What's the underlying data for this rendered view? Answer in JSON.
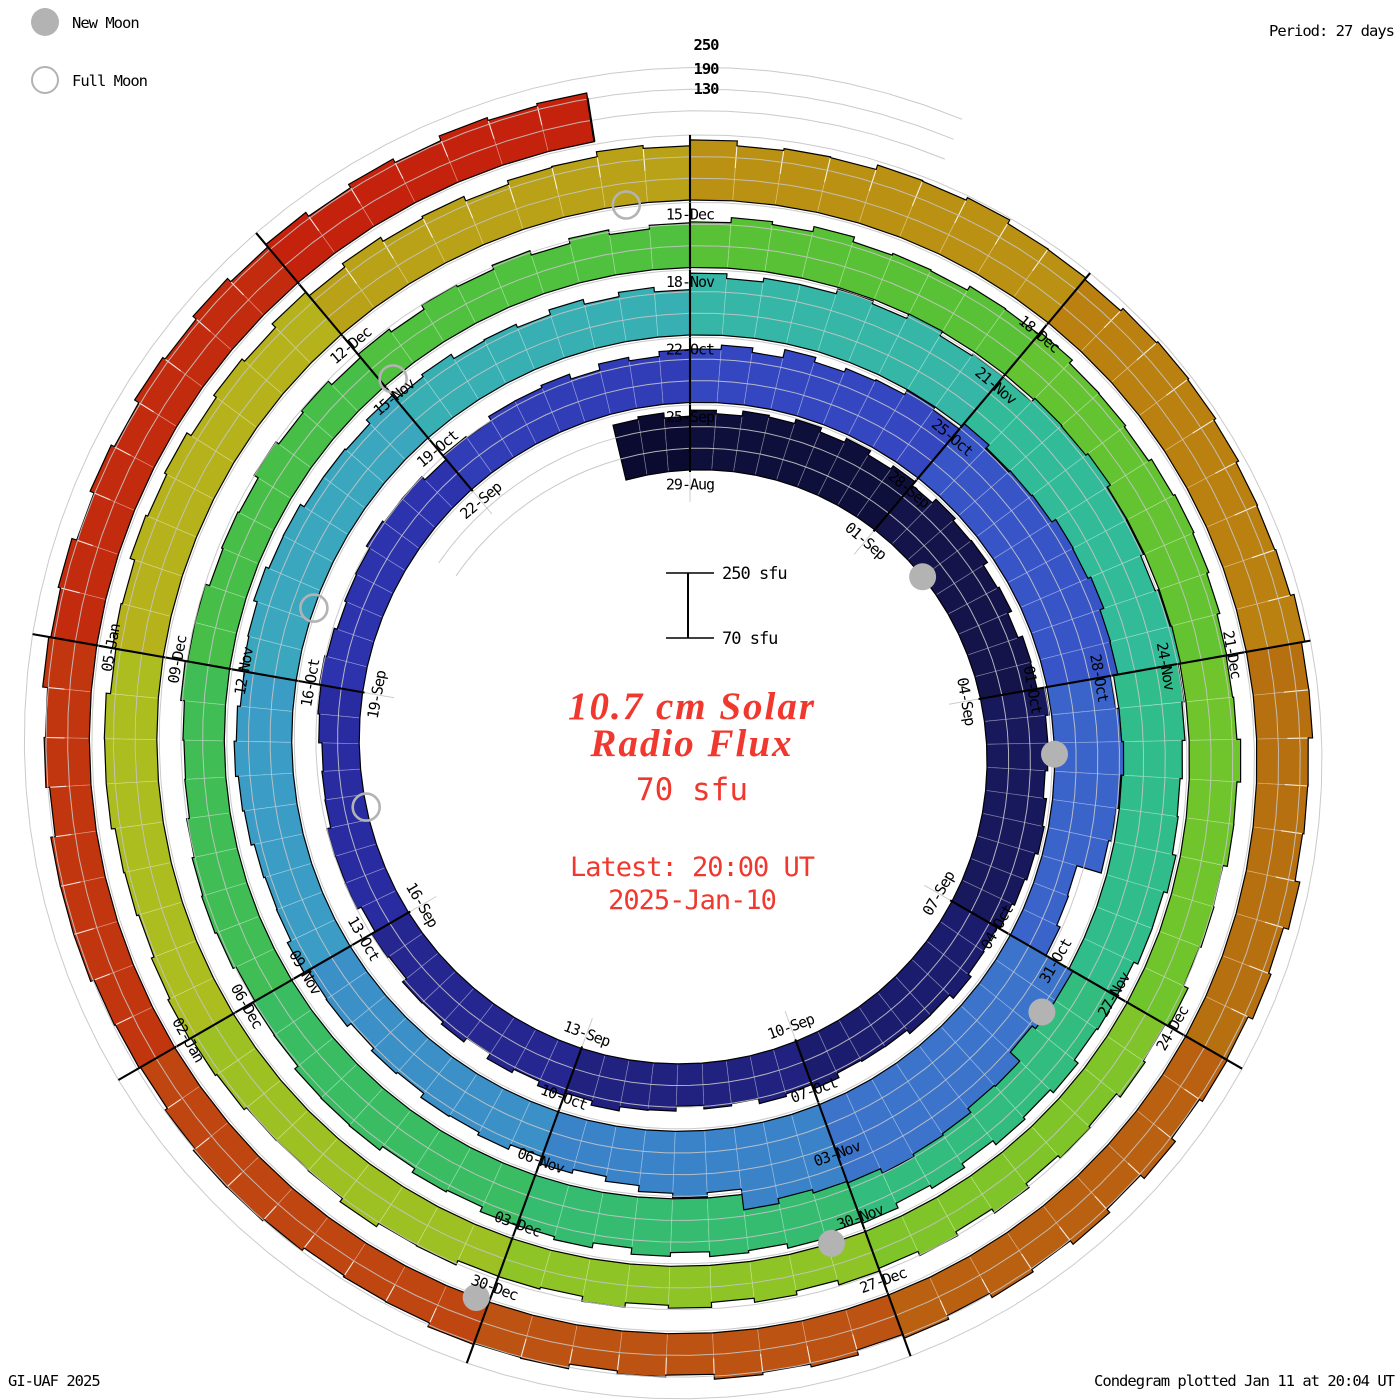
{
  "legend": {
    "new_moon_label": "New Moon",
    "full_moon_label": "Full Moon",
    "moon_color": "#b3b3b3"
  },
  "header": {
    "period_label": "Period: 27 days"
  },
  "footer": {
    "credit": "GI-UAF 2025",
    "plotted": "Condegram plotted Jan 11 at 20:04 UT"
  },
  "radial_axis": {
    "labels": [
      "250",
      "190",
      "130"
    ],
    "tops": [
      36,
      60,
      80
    ]
  },
  "scale_key": {
    "top_label": "250 sfu",
    "bottom_label": "70 sfu"
  },
  "center_text": {
    "title_line1": "10.7 cm Solar",
    "title_line2": "Radio Flux",
    "current_value": "70 sfu",
    "latest_line1": "Latest: 20:00 UT",
    "latest_line2": "2025-Jan-10",
    "accent_color": "#f0382e"
  },
  "chart_data": {
    "type": "spiral_bar",
    "title": "10.7 cm Solar Radio Flux condegram",
    "period_days": 27,
    "tick_step_days": 3,
    "flux_axis": {
      "min": 70,
      "max": 250,
      "gridlines": [
        130,
        190,
        250
      ],
      "units": "sfu"
    },
    "geometry": {
      "cx": 690,
      "cy": 750,
      "r0": 280,
      "ring_spacing": 67.5,
      "px_per_range": 65,
      "measurements_per_day": 3,
      "jitter_amp": 8,
      "t_start": -1,
      "t_end": 134.33,
      "label_inset": 15,
      "grid_t_min": -4,
      "grid_t_max": 136.8
    },
    "start_date": "2024-08-28",
    "end_date": "2025-01-10",
    "daily_flux": [
      228,
      236,
      241,
      243,
      239,
      233,
      228,
      245,
      241,
      232,
      222,
      212,
      205,
      200,
      197,
      208,
      206,
      199,
      192,
      187,
      184,
      183,
      187,
      191,
      189,
      197,
      205,
      213,
      224,
      237,
      250,
      262,
      272,
      276,
      258,
      250,
      178,
      268,
      298,
      310,
      296,
      248,
      222,
      211,
      206,
      204,
      211,
      218,
      225,
      229,
      224,
      218,
      212,
      206,
      202,
      238,
      247,
      253,
      259,
      261,
      255,
      247,
      239,
      233,
      229,
      225,
      229,
      233,
      229,
      221,
      213,
      207,
      201,
      197,
      193,
      189,
      187,
      185,
      183,
      185,
      189,
      193,
      205,
      211,
      215,
      217,
      215,
      211,
      207,
      201,
      197,
      193,
      189,
      185,
      183,
      181,
      185,
      191,
      197,
      201,
      205,
      209,
      213,
      217,
      219,
      219,
      215,
      211,
      223,
      231,
      236,
      239,
      237,
      233,
      229,
      223,
      216,
      209,
      203,
      199,
      197,
      195,
      193,
      191,
      189,
      188,
      189,
      191,
      195,
      199,
      201,
      204,
      206,
      205,
      203,
      201
    ],
    "tick_labels": [
      {
        "t": 0,
        "label": "29-Aug"
      },
      {
        "t": 3,
        "label": "01-Sep"
      },
      {
        "t": 6,
        "label": "04-Sep"
      },
      {
        "t": 9,
        "label": "07-Sep"
      },
      {
        "t": 12,
        "label": "10-Sep"
      },
      {
        "t": 15,
        "label": "13-Sep"
      },
      {
        "t": 18,
        "label": "16-Sep"
      },
      {
        "t": 21,
        "label": "19-Sep"
      },
      {
        "t": 24,
        "label": "22-Sep"
      },
      {
        "t": 27,
        "label": "25-Sep"
      },
      {
        "t": 30,
        "label": "28-Sep"
      },
      {
        "t": 33,
        "label": "01-Oct"
      },
      {
        "t": 36,
        "label": "04-Oct"
      },
      {
        "t": 39,
        "label": "07-Oct"
      },
      {
        "t": 42,
        "label": "10-Oct"
      },
      {
        "t": 45,
        "label": "13-Oct"
      },
      {
        "t": 48,
        "label": "16-Oct"
      },
      {
        "t": 51,
        "label": "19-Oct"
      },
      {
        "t": 54,
        "label": "22-Oct"
      },
      {
        "t": 57,
        "label": "25-Oct"
      },
      {
        "t": 60,
        "label": "28-Oct"
      },
      {
        "t": 63,
        "label": "31-Oct"
      },
      {
        "t": 66,
        "label": "03-Nov"
      },
      {
        "t": 69,
        "label": "06-Nov"
      },
      {
        "t": 72,
        "label": "09-Nov"
      },
      {
        "t": 75,
        "label": "12-Nov"
      },
      {
        "t": 78,
        "label": "15-Nov"
      },
      {
        "t": 81,
        "label": "18-Nov"
      },
      {
        "t": 84,
        "label": "21-Nov"
      },
      {
        "t": 87,
        "label": "24-Nov"
      },
      {
        "t": 90,
        "label": "27-Nov"
      },
      {
        "t": 93,
        "label": "30-Nov"
      },
      {
        "t": 96,
        "label": "03-Dec"
      },
      {
        "t": 99,
        "label": "06-Dec"
      },
      {
        "t": 102,
        "label": "09-Dec"
      },
      {
        "t": 105,
        "label": "12-Dec"
      },
      {
        "t": 108,
        "label": "15-Dec"
      },
      {
        "t": 111,
        "label": "18-Dec"
      },
      {
        "t": 114,
        "label": "21-Dec"
      },
      {
        "t": 117,
        "label": "24-Dec"
      },
      {
        "t": 120,
        "label": "27-Dec"
      },
      {
        "t": 123,
        "label": "30-Dec"
      },
      {
        "t": 126,
        "label": "02-Jan"
      },
      {
        "t": 129,
        "label": "05-Jan"
      }
    ],
    "moons": {
      "radius": 13.5,
      "color": "#b3b3b3",
      "new_t": [
        4.0,
        33.8,
        63.5,
        93.3,
        123.1
      ],
      "new_dates": [
        "2024-09-03",
        "2024-10-02",
        "2024-11-01",
        "2024-12-01",
        "2024-12-30"
      ],
      "full_t": [
        19.5,
        48.8,
        78.1,
        107.5
      ],
      "full_dates": [
        "2024-09-18",
        "2024-10-17",
        "2024-11-15",
        "2024-12-15"
      ]
    },
    "colormap": [
      [
        -1,
        "#0a0a2e"
      ],
      [
        4,
        "#131347"
      ],
      [
        9,
        "#1a1a66"
      ],
      [
        15,
        "#232387"
      ],
      [
        21,
        "#2b2ea8"
      ],
      [
        27,
        "#3340bc"
      ],
      [
        31,
        "#3752c6"
      ],
      [
        35,
        "#3a66ca"
      ],
      [
        39,
        "#3b7cca"
      ],
      [
        44,
        "#3c92c8"
      ],
      [
        49,
        "#3aa6c1"
      ],
      [
        54,
        "#36b3ad"
      ],
      [
        59,
        "#31bc96"
      ],
      [
        64,
        "#31bd80"
      ],
      [
        70,
        "#38bc64"
      ],
      [
        76,
        "#45be49"
      ],
      [
        82,
        "#57c137"
      ],
      [
        88,
        "#6ec42c"
      ],
      [
        94,
        "#8bc426"
      ],
      [
        100,
        "#a9bf1f"
      ],
      [
        104,
        "#b7b01b"
      ],
      [
        108,
        "#ba9a15"
      ],
      [
        112,
        "#ba8310"
      ],
      [
        116,
        "#b76d10"
      ],
      [
        120,
        "#ba5a12"
      ],
      [
        124,
        "#bf4711"
      ],
      [
        128,
        "#c2340f"
      ],
      [
        134,
        "#c51f0d"
      ]
    ],
    "grid_color": "#c4c4c4",
    "outline_color": "#000000",
    "label_font_px": 15
  }
}
